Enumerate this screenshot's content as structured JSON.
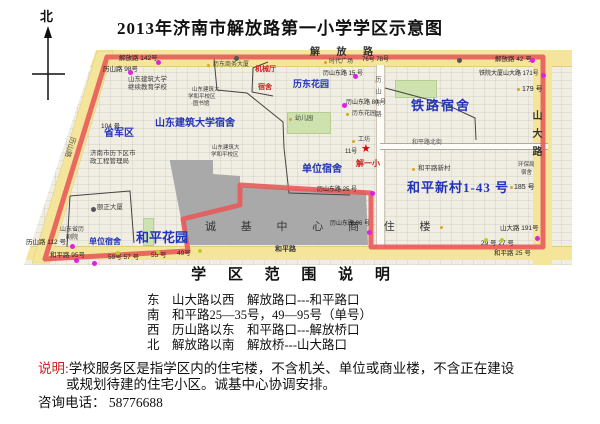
{
  "colors": {
    "boundary_red": "#e85a5a",
    "road_yellow": "#f4e59a",
    "blue_label": "#2233bb",
    "red_label": "#cc2222",
    "gray_block": "#a9a9a9",
    "green_area": "#cde2ae",
    "magenta_marker": "#dd22dd",
    "green_marker": "#bccc2a",
    "poi_yellow": "#d8a820"
  },
  "header": {
    "compass_label": "北",
    "title": "2013年济南市解放路第一小学学区示意图"
  },
  "map": {
    "road_labels": {
      "jiefang": "解 放 路",
      "shanda": "山大路",
      "heping": "和平路",
      "heping_north": "和平路北街",
      "lishan": "历山路",
      "lishan_east": "历山东路"
    },
    "area_labels": [
      "山东建筑大学宿舍",
      "省军区",
      "历东花园",
      "铁路宿舍",
      "单位宿舍",
      "单位宿舍",
      "和平花园",
      "和平新村1-43 号"
    ],
    "red_labels": {
      "jixieting": "机械厅",
      "jixieting_sushe": "宿舍",
      "school": "解一小",
      "school_star": "★"
    },
    "block_label": "诚 基 中 心 商 住 楼",
    "building_labels": [
      "历东商务大厦",
      "时代广场",
      "山东建筑大学",
      "继续教育学校",
      "山东建筑大",
      "学和平校区",
      "·图书馆",
      "山东建筑大",
      "学和平校区",
      "济南市历下区市",
      "政工程管理局",
      "颐正大厦",
      "山东省历",
      "剧院",
      "和平路新村",
      "历东花园",
      "工坊",
      "幼儿园",
      "环保局",
      "宿舍"
    ],
    "address_labels": [
      "解放路 142号",
      "历山路 98号",
      "104 号",
      "历山路 112 号",
      "和平路 95号",
      "59号 57 号",
      "55 号",
      "49号",
      "历山东路 15 号",
      "76号 78号",
      "解放路 42 号",
      "铁院大厦山大路 171号",
      "179 号",
      "185 号",
      "历山东路 80 号",
      "11号",
      "历山东路 25 号",
      "历山东路 96 号",
      "山大路 191号",
      "29 号 27 号",
      "和平路 25 号"
    ]
  },
  "legend": {
    "heading": "学 区 范 围 说 明",
    "lines": [
      "东　山大路以西　解放路口---和平路口",
      "南　和平路25—35号，49—95号（单号）",
      "西　历山路以东　和平路口---解放桥口",
      "北　解放路以南　解放桥---山大路口"
    ]
  },
  "notes": {
    "label": "说明:",
    "line1": "学校服务区是指学区内的住宅楼，不含机关、单位或商业楼，不含正在建设",
    "line2": "或规划待建的住宅小区。诚基中心协调安排。",
    "phone": "咨询电话： 58776688"
  }
}
